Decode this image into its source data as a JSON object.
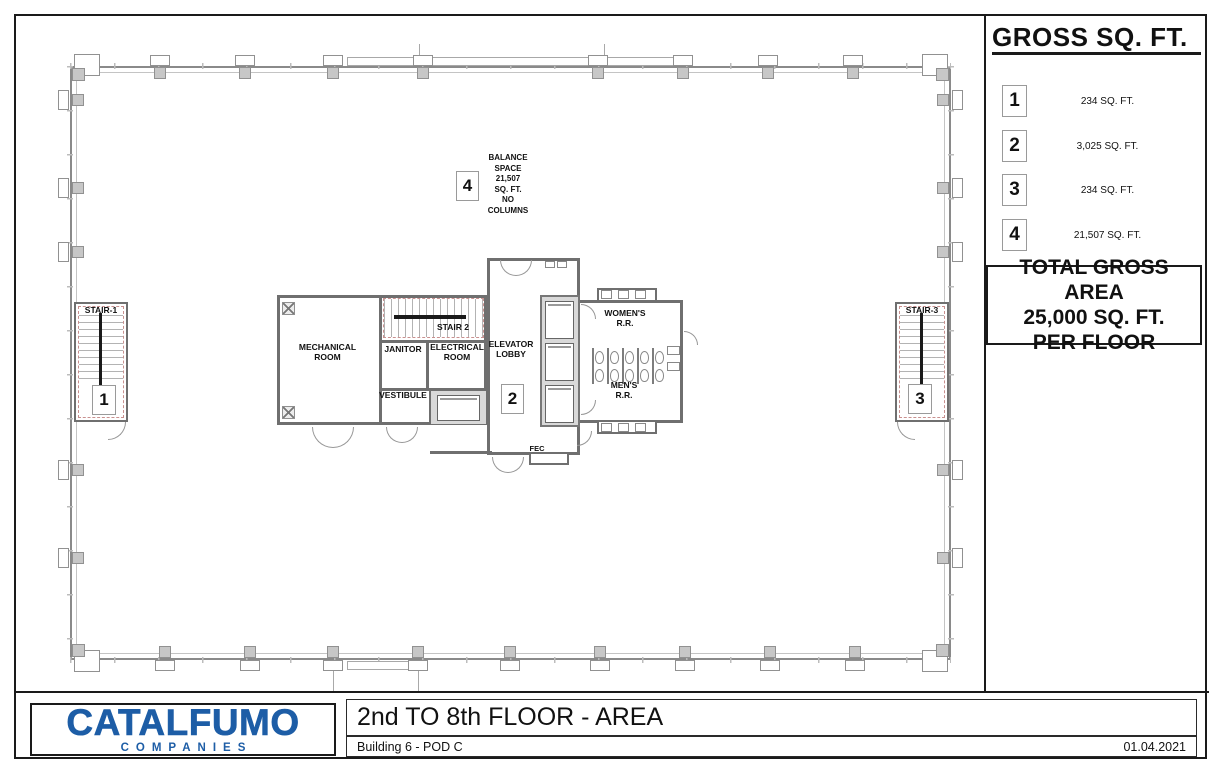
{
  "legend": {
    "title": "GROSS SQ. FT.",
    "items": [
      {
        "num": "1",
        "area": "234 SQ. FT."
      },
      {
        "num": "2",
        "area": "3,025 SQ. FT."
      },
      {
        "num": "3",
        "area": "234 SQ. FT."
      },
      {
        "num": "4",
        "area": "21,507 SQ. FT."
      }
    ],
    "total": "TOTAL GROSS AREA\n25,000 SQ. FT.\nPER FLOOR"
  },
  "plan": {
    "labels": {
      "stair1": "STAIR-1",
      "stair2": "STAIR 2",
      "stair3": "STAIR-3",
      "mechanical": "MECHANICAL\nROOM",
      "janitor": "JANITOR",
      "electrical": "ELECTRICAL\nROOM",
      "elevator_lobby": "ELEVATOR\nLOBBY",
      "vestibule": "VESTIBULE",
      "womens": "WOMEN'S\nR.R.",
      "mens": "MEN'S\nR.R.",
      "fec": "FEC"
    },
    "markers": {
      "stair1": "1",
      "lobby": "2",
      "stair3": "3",
      "balance": "4"
    },
    "balance_note": "BALANCE\nSPACE\n21,507\nSQ. FT.\nNO\nCOLUMNS"
  },
  "titleblock": {
    "logo_name": "CATALFUMO",
    "logo_sub": "COMPANIES",
    "title": "2nd TO 8th FLOOR - AREA",
    "subtitle": "Building 6 - POD C",
    "date": "01.04.2021"
  },
  "colors": {
    "logo_blue": "#1d5da6",
    "wall_gray": "#6f6f6f",
    "column_fill": "#c7c7c7",
    "rated_red": "#c9908f"
  }
}
